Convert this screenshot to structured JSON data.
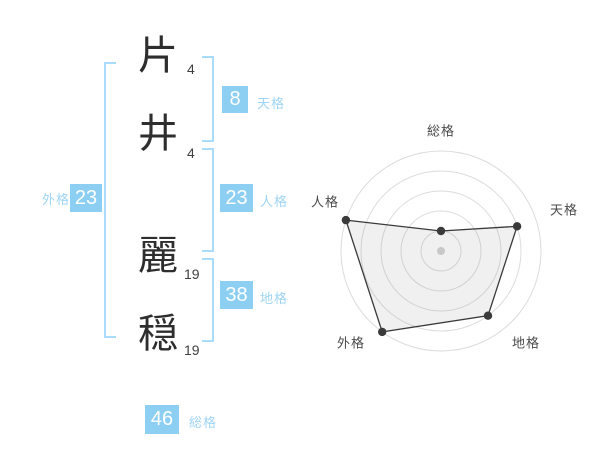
{
  "name": {
    "chars": [
      {
        "char": "片",
        "strokes": "4"
      },
      {
        "char": "井",
        "strokes": "4"
      },
      {
        "char": "麗",
        "strokes": "19"
      },
      {
        "char": "穏",
        "strokes": "19"
      }
    ]
  },
  "categories": {
    "tenkaku": {
      "label": "天格",
      "value": "8"
    },
    "jinkaku": {
      "label": "人格",
      "value": "23"
    },
    "chikaku": {
      "label": "地格",
      "value": "38"
    },
    "gaikaku": {
      "label": "外格",
      "value": "23"
    },
    "soukaku": {
      "label": "総格",
      "value": "46"
    }
  },
  "chart_data": {
    "type": "radar",
    "axes": [
      "総格",
      "天格",
      "地格",
      "外格",
      "人格"
    ],
    "series": [
      {
        "name": "score",
        "values": [
          1,
          4,
          4,
          5,
          5
        ]
      }
    ],
    "max": 5,
    "rings": 5,
    "start": "top",
    "direction": "clockwise",
    "legend_position": "none",
    "grid": true
  },
  "colors": {
    "badge_blue": "#8dcff2",
    "label_blue": "#9fd5f4",
    "bracket_blue": "#a8dcf8",
    "grid_gray": "#dcdcdc",
    "line_dark": "#3a3a3a",
    "center_dot_gray": "#c8c8c8",
    "text_dark": "#2e2e2e"
  }
}
